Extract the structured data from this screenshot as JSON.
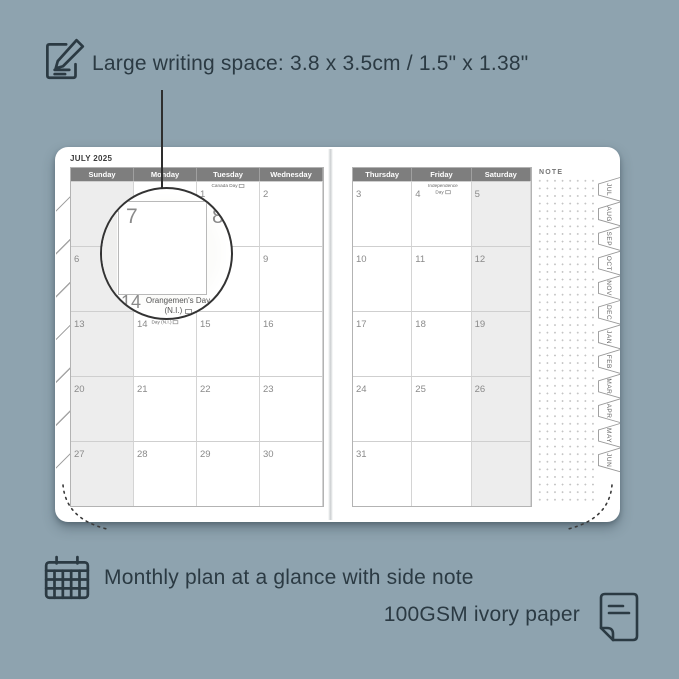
{
  "colors": {
    "background": "#8EA3AF",
    "ink": "#2B3A43",
    "page": "#FFFFFF",
    "header_bar": "#7E7E7E",
    "weekend_shade": "#EDEDED",
    "grid_line": "#CFCFCF",
    "date_gray": "#8A8A8A"
  },
  "top_annotation": {
    "icon": "pencil-note-icon",
    "text": "Large writing space: 3.8 x 3.5cm / 1.5\" x 1.38\""
  },
  "planner": {
    "month_title": "JULY 2025",
    "note_label": "NOTE",
    "left_page": {
      "day_headers": [
        "Sunday",
        "Monday",
        "Tuesday",
        "Wednesday"
      ],
      "rows": [
        [
          {
            "d": ""
          },
          {
            "d": ""
          },
          {
            "d": "1",
            "h": "Canada Day",
            "f": true
          },
          {
            "d": "2"
          }
        ],
        [
          {
            "d": "6"
          },
          {
            "d": "7"
          },
          {
            "d": "8"
          },
          {
            "d": "9"
          }
        ],
        [
          {
            "d": "13"
          },
          {
            "d": "14",
            "h": "Orangemen's Day (N.I.)",
            "f": true
          },
          {
            "d": "15"
          },
          {
            "d": "16"
          }
        ],
        [
          {
            "d": "20"
          },
          {
            "d": "21"
          },
          {
            "d": "22"
          },
          {
            "d": "23"
          }
        ],
        [
          {
            "d": "27"
          },
          {
            "d": "28"
          },
          {
            "d": "29"
          },
          {
            "d": "30"
          }
        ]
      ]
    },
    "right_page": {
      "day_headers": [
        "Thursday",
        "Friday",
        "Saturday"
      ],
      "rows": [
        [
          {
            "d": "3"
          },
          {
            "d": "4",
            "h": "Independence Day",
            "f": true
          },
          {
            "d": "5"
          }
        ],
        [
          {
            "d": "10"
          },
          {
            "d": "11"
          },
          {
            "d": "12"
          }
        ],
        [
          {
            "d": "17"
          },
          {
            "d": "18"
          },
          {
            "d": "19"
          }
        ],
        [
          {
            "d": "24"
          },
          {
            "d": "25"
          },
          {
            "d": "26"
          }
        ],
        [
          {
            "d": "31"
          },
          {
            "d": ""
          },
          {
            "d": ""
          }
        ]
      ]
    },
    "month_tabs": [
      "JUL",
      "AUG",
      "SEP",
      "OCT",
      "NOV",
      "DEC",
      "JAN",
      "FEB",
      "MAR",
      "APR",
      "MAY",
      "JUN"
    ]
  },
  "magnifier": {
    "big_day": "7",
    "next_day": "8",
    "bottom_day": "14",
    "holiday_line1": "Orangemen's Day",
    "holiday_line2": "(N.I.)"
  },
  "bottom_annotation": {
    "calendar_icon": "calendar-grid-icon",
    "line1": "Monthly plan at a glance with side note",
    "line2": "100GSM ivory paper",
    "paper_icon": "ivory-paper-icon"
  }
}
